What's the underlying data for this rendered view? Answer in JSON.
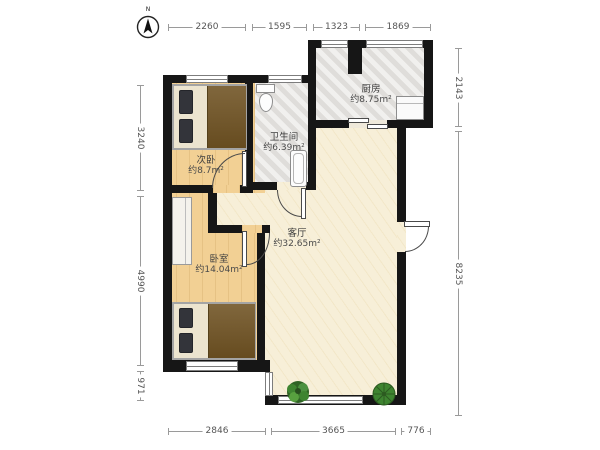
{
  "compass": {
    "label": "N"
  },
  "rooms": [
    {
      "name": "次卧",
      "area": "约8.7m²"
    },
    {
      "name": "卫生间",
      "area": "约6.39m²"
    },
    {
      "name": "厨房",
      "area": "约8.75m²"
    },
    {
      "name": "客厅",
      "area": "约32.65m²"
    },
    {
      "name": "卧室",
      "area": "约14.04m²"
    }
  ],
  "dimensions_mm": {
    "top": [
      "2260",
      "1595",
      "1323",
      "1869"
    ],
    "bottom": [
      "2846",
      "3665",
      "776"
    ],
    "left": [
      "3240",
      "4990",
      "971"
    ],
    "right": [
      "2143",
      "8235"
    ]
  },
  "colors": {
    "wall": "#161616",
    "bedroom_floor": "#f2d094",
    "living_floor": "#f7efd8",
    "tile_floor": "#e5e3e0",
    "duvet": "#6f5222",
    "plant_green": "#3e8430",
    "dimension_text": "#555555"
  }
}
